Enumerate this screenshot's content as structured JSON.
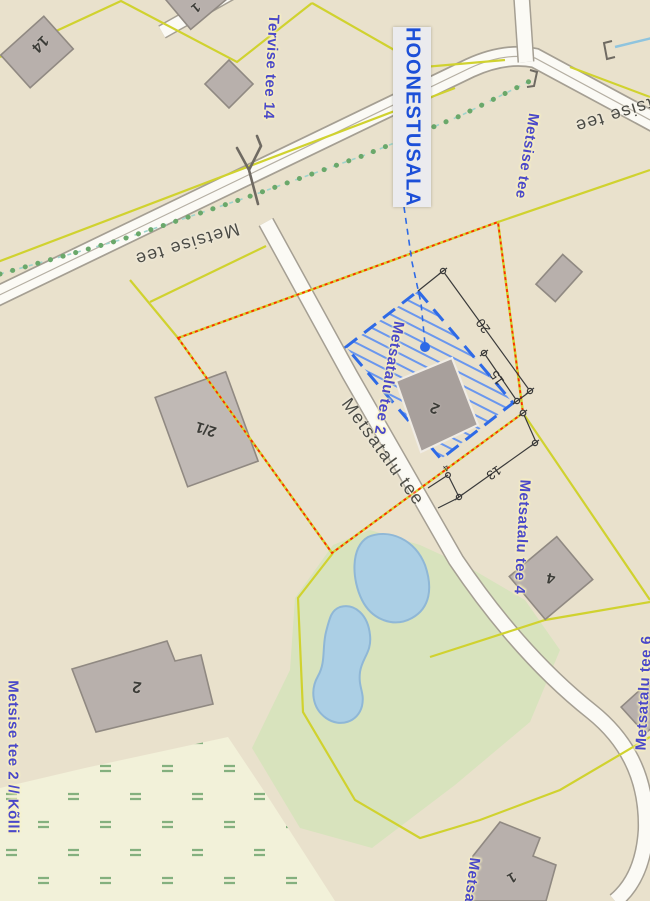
{
  "callout": {
    "label": "HOONESTUSALA"
  },
  "street_labels": {
    "tervise14": "Tervise tee 14",
    "metsise": "Metsise tee",
    "metsatalu2": "Metsatalu tee 2",
    "metsatalu4": "Metsatalu tee 4",
    "metsatalu6": "Metsatalu tee 6",
    "metsise2": "Metsise tee 2 // Kõlli",
    "metsa_partial": "Metsa"
  },
  "road_labels": {
    "metsise_left": "Metsise tee",
    "metsise_right": "Metsise tee",
    "metsatalu": "Metsatalu tee"
  },
  "building_labels": {
    "b14": "14",
    "b1_top": "1",
    "b21": "2/1",
    "b2_plot": "2",
    "b4": "4",
    "b2_south": "2",
    "b1_south": "1"
  },
  "dimensions": {
    "d20": "20",
    "d15": "15",
    "d13": "13",
    "d4": "4"
  },
  "colors": {
    "background_beige": "#e9e1cc",
    "callout_blue": "#1c4fd8",
    "hatch_blue": "#2e6ae6",
    "boundary_red": "#ff2a00",
    "cadastral_yellow": "#d0d22f",
    "street_label_blue": "#4a48c9",
    "road_label_gray": "#4c4c46",
    "green_area": "#d8e3bd",
    "wetland_pale": "#f2f1d9",
    "pond_blue": "#abcfe5",
    "building_gray": "#b8b0ac"
  }
}
